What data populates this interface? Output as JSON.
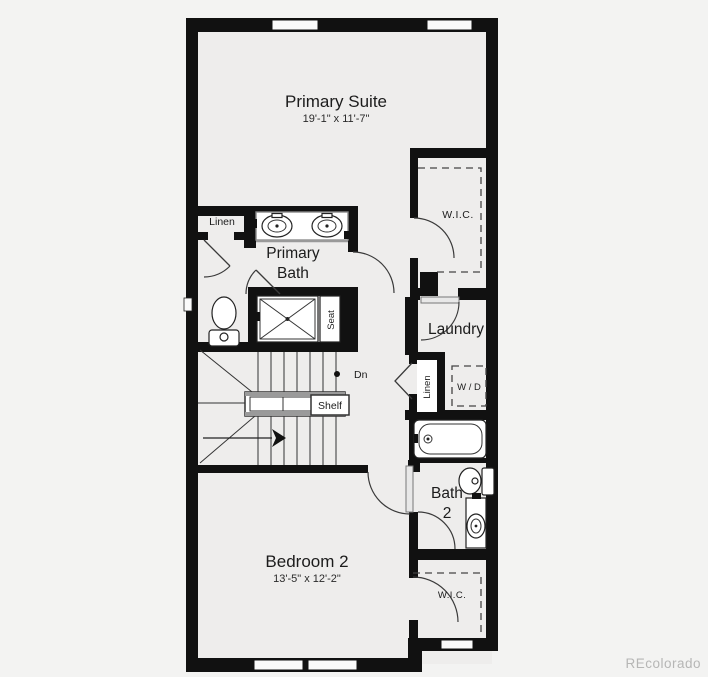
{
  "colors": {
    "wall": "#111111",
    "background": "#f3f3f2",
    "floor": "#eeedec",
    "door_arc": "#3a3a3a",
    "watermark": "#b6b6b5"
  },
  "rooms": {
    "primary_suite": {
      "name": "Primary Suite",
      "dims": "19'-1\" x 11'-7\""
    },
    "primary_bath": {
      "name_line1": "Primary",
      "name_line2": "Bath"
    },
    "wic_top": {
      "name": "W.I.C."
    },
    "laundry": {
      "name": "Laundry"
    },
    "bath2": {
      "name_line1": "Bath",
      "name_line2": "2"
    },
    "bedroom2": {
      "name": "Bedroom 2",
      "dims": "13'-5\" x 12'-2\""
    },
    "wic_bottom": {
      "name": "W.I.C."
    }
  },
  "annotations": {
    "linen_top": "Linen",
    "linen_laundry": "Linen",
    "seat": "Seat",
    "shelf": "Shelf",
    "down": "Dn",
    "washer_dryer": "W / D"
  },
  "watermark": "REcolorado"
}
